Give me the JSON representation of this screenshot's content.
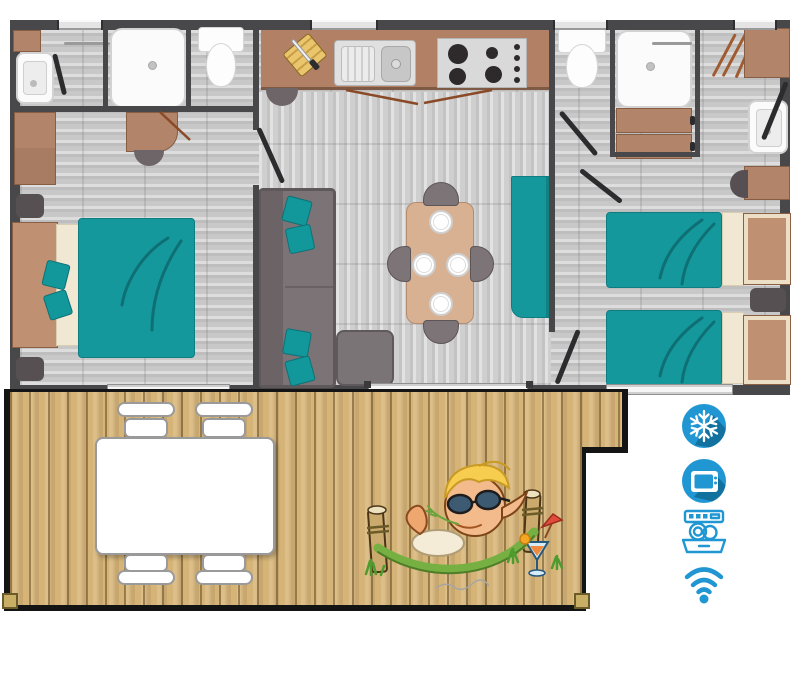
{
  "document": {
    "type": "mobile-home-floorplan-with-terrace",
    "background": "#ffffff"
  },
  "palette": {
    "wall": "#48484b",
    "interior_floor": "#c8c8c8",
    "deck_wood": "#d6b477",
    "kitchen_counter": "#b28165",
    "furniture_brown": "#b2846a",
    "bed_teal": "#14989c",
    "sofa_gray": "#7b7376",
    "fixture_white": "#fbfbfb",
    "icon_blue": "#2096d3",
    "icon_blue_shadow": "#13719f",
    "hammock_green": "#76b043"
  },
  "amenities": {
    "items": [
      {
        "name": "air-conditioning",
        "icon": "snowflake-icon",
        "badge": "circle"
      },
      {
        "name": "tv",
        "icon": "tv-icon",
        "badge": "circle"
      },
      {
        "name": "dishwasher",
        "icon": "dishwasher-icon",
        "badge": "outline"
      },
      {
        "name": "wifi",
        "icon": "wifi-icon",
        "badge": "outline"
      }
    ]
  },
  "floorplan": {
    "areas": [
      {
        "name": "bathroom"
      },
      {
        "name": "wc"
      },
      {
        "name": "double-bedroom"
      },
      {
        "name": "kitchen"
      },
      {
        "name": "living-dining"
      },
      {
        "name": "shower-room"
      },
      {
        "name": "twin-bedroom"
      },
      {
        "name": "terrace"
      }
    ],
    "counts": {
      "double_beds": 1,
      "single_beds": 2,
      "showers": 2,
      "toilets": 2,
      "washbasins": 3,
      "dining_plates": 4,
      "dining_chairs": 4,
      "terrace_chairs": 4
    }
  }
}
